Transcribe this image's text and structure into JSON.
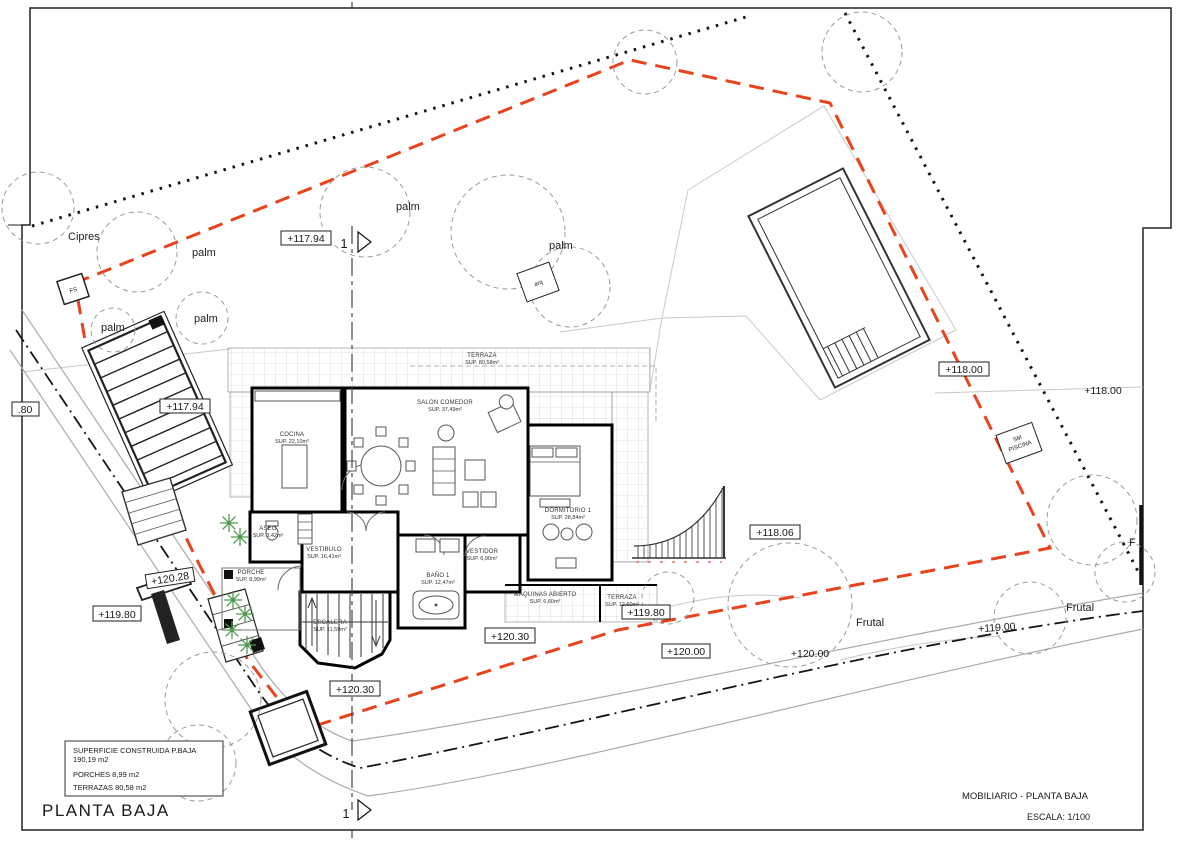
{
  "title": "PLANTA BAJA",
  "footer": {
    "right_title": "MOBILIARIO - PLANTA BAJA",
    "scale": "ESCALA: 1/100"
  },
  "legend": {
    "line1": "SUPERFICIE CONSTRUIDA P.BAJA",
    "line2": "190,19 m2",
    "line3": "PORCHES   8,99 m2",
    "line4": "TERRAZAS  80,58 m2"
  },
  "rooms": [
    {
      "name": "TERRAZA",
      "area": "SUP. 80,58m²"
    },
    {
      "name": "COCINA",
      "area": "SUP. 22,10m²"
    },
    {
      "name": "SALON COMEDOR",
      "area": "SUP. 37,49m²"
    },
    {
      "name": "DORMITORIO 1",
      "area": "SUP. 28,84m²"
    },
    {
      "name": "ASEO",
      "area": "SUP. 3,42m²"
    },
    {
      "name": "VESTIBULO",
      "area": "SUP. 16,41m²"
    },
    {
      "name": "PORCHE",
      "area": "SUP. 8,99m²"
    },
    {
      "name": "ESCALERA",
      "area": "SUP. 11,59m²"
    },
    {
      "name": "BAÑO 1",
      "area": "SUP. 12,47m²"
    },
    {
      "name": "VESTIDOR",
      "area": "SUP. 6,90m²"
    },
    {
      "name": "MAQUINAS ABIERTO",
      "area": "SUP. 6,60m²"
    },
    {
      "name": "TERRAZA",
      "area": "SUP. 12,60m²"
    }
  ],
  "levels": [
    "+117.94",
    "+117.94",
    "+118.00",
    "+118.00",
    "+118.06",
    "+120.28",
    "+119.80",
    "+120.30",
    "+120.30",
    "+119.80",
    "+120.00",
    "+120.00",
    "+119.00",
    ".80"
  ],
  "veg": {
    "cipres": "Cipres",
    "palm": "palm",
    "frutal": "Frutal",
    "f": "F"
  },
  "markers": {
    "fs": "FS",
    "arq": "arq",
    "sm_line1": "SM",
    "sm_line2": "PISCINA",
    "section_number": "1"
  },
  "colors": {
    "setback_red": "#E8431C",
    "boundary_black": "#141414",
    "road_gray": "#ABABAB",
    "plant_green": "#4E9B4E",
    "grid_gray": "#C4C4C4"
  }
}
